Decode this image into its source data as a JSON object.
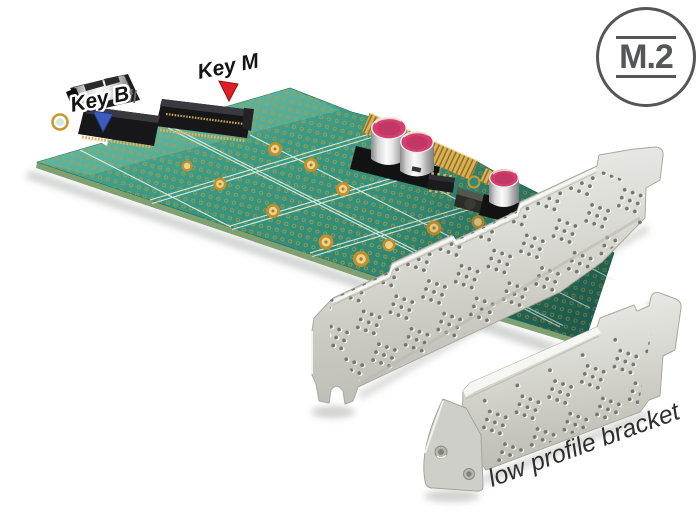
{
  "badge": {
    "text": "M.2"
  },
  "callouts": {
    "key_b": "Key B",
    "key_m": "Key M"
  },
  "caption": "low profile bracket",
  "colors": {
    "background": "#FFFFFF",
    "pcb_teal": "#37957F",
    "pcb_teal_light": "#5FB8A5",
    "pcb_teal_dark": "#256F60",
    "solder_pad_gold": "#C9992E",
    "pcie_finger_gold": "#D8B254",
    "bracket_silver": "#D8D8D2",
    "capacitor_top_pink": "#D63E72",
    "connector_black": "#17171A",
    "key_b_arrow_blue": "#3B5BBF",
    "key_m_arrow_red": "#E01E25",
    "badge_outline_gray": "#55565A",
    "label_text": "#141414"
  }
}
